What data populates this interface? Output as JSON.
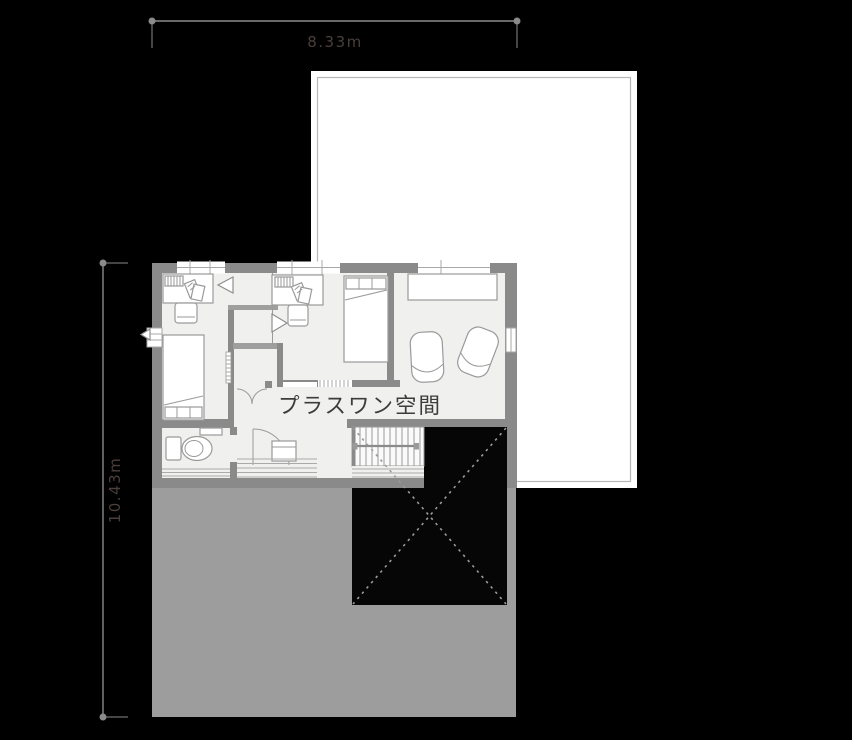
{
  "page": {
    "background": "#000000"
  },
  "dimension_labels": {
    "width": "8.33m",
    "height": "10.43m"
  },
  "floor_plan": {
    "room_label": "プラスワン空間"
  },
  "colors": {
    "background": "#000000",
    "building_outline_fill": "#ffffff",
    "building_outline_inner_stroke": "#b7b7b3",
    "roof": "#9d9d9d",
    "floor": "#f0f0ee",
    "wall": "#8a8a8a",
    "stair_void": "#060606",
    "void_cross": "#9b9b9b",
    "dimension_line": "#8a8a8a",
    "dimension_text": "#4a3f3b",
    "room_label_text": "#3c3c3c"
  }
}
